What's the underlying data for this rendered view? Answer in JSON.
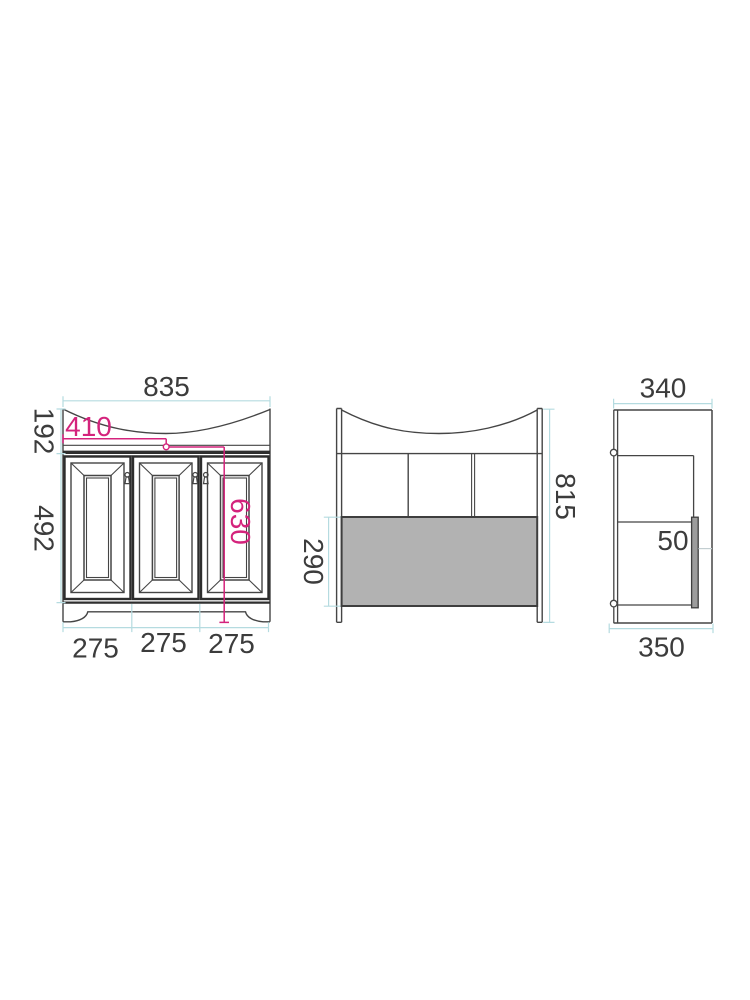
{
  "diagram": {
    "front_view": {
      "overall_width": "835",
      "countertop_section_height": "192",
      "door_section_height": "492",
      "basin_center_offset": "410",
      "height_to_counter": "630",
      "door_widths": [
        "275",
        "275",
        "275"
      ]
    },
    "back_view": {
      "overall_height": "815",
      "lower_panel_height": "290"
    },
    "side_view": {
      "top_depth": "340",
      "bottom_depth": "350",
      "back_panel_gap": "50"
    },
    "colors": {
      "line": "#454545",
      "dimension_line": "#b5dbe0",
      "accent_pink": "#d4237c",
      "panel_gray": "#b2b2b2"
    }
  }
}
